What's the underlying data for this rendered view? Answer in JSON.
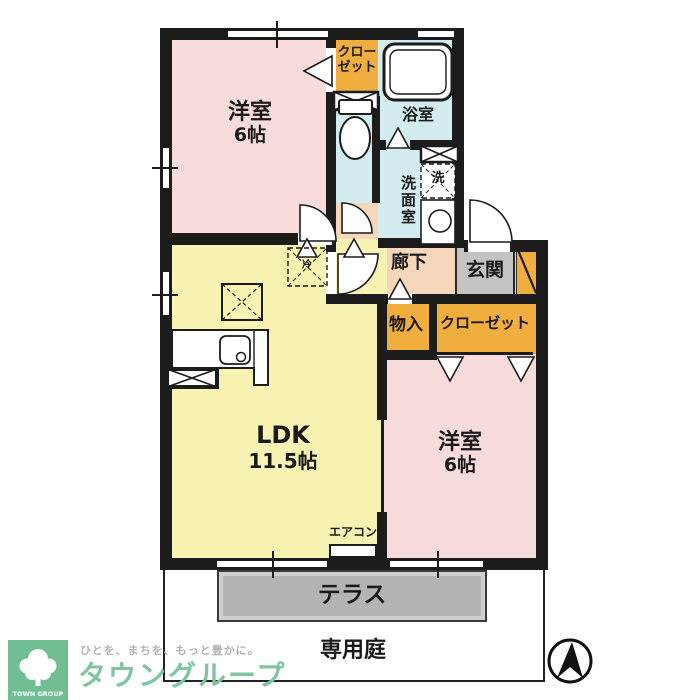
{
  "rooms": {
    "bedroom_top": {
      "label": "洋室",
      "size": "6帖"
    },
    "bedroom_bottom": {
      "label": "洋室",
      "size": "6帖"
    },
    "ldk": {
      "label": "LDK",
      "size": "11.5帖"
    },
    "bath": {
      "label": "浴室"
    },
    "washroom": {
      "label": "洗面室"
    },
    "hallway": {
      "label": "廊下"
    },
    "entrance": {
      "label": "玄関"
    },
    "storage": {
      "label": "物入"
    },
    "closet_top": {
      "line1": "クロー",
      "line2": "ゼット"
    },
    "closet_bottom": {
      "label": "クローゼット"
    }
  },
  "fixtures": {
    "aircon_label": "エアコン",
    "washer_label": "洗",
    "fridge_label": "冷"
  },
  "exterior": {
    "terrace_label": "テラス",
    "garden_label": "専用庭"
  },
  "footer": {
    "logo_text": "TOWN GROUP",
    "tagline": "ひとを、まちを、もっと豊かに。",
    "brand": "タウングループ"
  },
  "colors": {
    "wall": "#1c1c1c",
    "room_pink": "#f8dcdc",
    "ldk_yellow": "#f8f3b2",
    "closet_orange": "#efae3e",
    "water_blue": "#d2ecf0",
    "hall_peach": "#f6d7bb",
    "entrance_gray": "#c3c3c3",
    "terrace_gray": "#b4b4b4",
    "brand_green": "#7cc49d"
  }
}
